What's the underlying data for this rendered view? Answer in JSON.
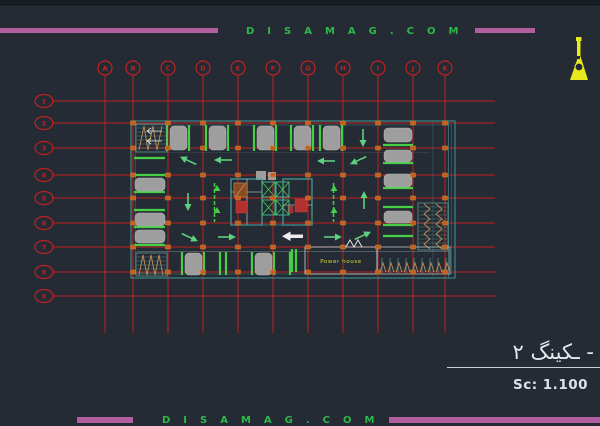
{
  "banner_top": {
    "text": "DISAMAG.COM"
  },
  "banner_bottom": {
    "text": "DISAMAG.COM"
  },
  "grid": {
    "columns": [
      {
        "label": "A",
        "x": 105
      },
      {
        "label": "B",
        "x": 133
      },
      {
        "label": "C",
        "x": 168
      },
      {
        "label": "D",
        "x": 203
      },
      {
        "label": "E",
        "x": 238
      },
      {
        "label": "F",
        "x": 273
      },
      {
        "label": "G",
        "x": 308
      },
      {
        "label": "H",
        "x": 343
      },
      {
        "label": "I",
        "x": 378
      },
      {
        "label": "J",
        "x": 413
      },
      {
        "label": "K",
        "x": 445
      }
    ],
    "rows": [
      {
        "label": "1",
        "y": 101
      },
      {
        "label": "2",
        "y": 123
      },
      {
        "label": "3",
        "y": 148
      },
      {
        "label": "4",
        "y": 175
      },
      {
        "label": "5",
        "y": 198
      },
      {
        "label": "6",
        "y": 223
      },
      {
        "label": "7",
        "y": 247
      },
      {
        "label": "8",
        "y": 272
      },
      {
        "label": "9",
        "y": 296
      }
    ],
    "col_line_top": 75,
    "col_line_bottom": 333,
    "col_bubble_cy": 68,
    "row_line_left": 52,
    "row_line_right": 495,
    "row_bubble_cx": 44
  },
  "plan": {
    "power_house_label": "Power house"
  },
  "title_block": {
    "drawing_title": "ـکینگ ۲ -",
    "scale_label": "Sc: 1.100"
  },
  "colors": {
    "background": "#242b34",
    "accent_magenta": "#b25fa0",
    "brand_green": "#2db84a",
    "grid_red": "#bf2121",
    "plan_teal": "#3e9191",
    "stall_green": "#46cf46",
    "stall_gray": "#9e9e9e",
    "column_orange": "#bf6020",
    "hatch_tan": "#c09058",
    "highlight_yellow": "#d8d838",
    "text_white": "#e3e7ea"
  }
}
